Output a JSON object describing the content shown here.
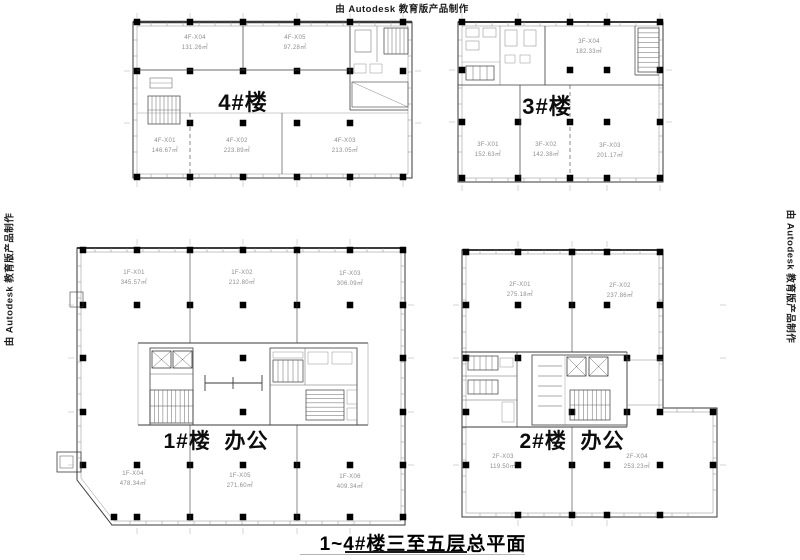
{
  "watermarks": {
    "top": "由 Autodesk 教育版产品制作",
    "left": "由 Autodesk 教育版产品制作",
    "right": "由 Autodesk 教育版产品制作"
  },
  "sheet": {
    "title": "1~4#楼三至五层总平面"
  },
  "colors": {
    "line": "#3a3a3a",
    "light_line": "#888888",
    "faint_line": "#aaaaaa",
    "room_text": "#8d8d8d",
    "label_text": "#0d0d0d"
  },
  "buildings": [
    {
      "id": "building-4",
      "label": "4#楼",
      "rooms": [
        {
          "code": "4F-X04",
          "area": "131.26㎡"
        },
        {
          "code": "4F-X05",
          "area": "97.28㎡"
        },
        {
          "code": "4F-X01",
          "area": "146.67㎡"
        },
        {
          "code": "4F-X02",
          "area": "223.89㎡"
        },
        {
          "code": "4F-X03",
          "area": "213.05㎡"
        }
      ]
    },
    {
      "id": "building-3",
      "label": "3#楼",
      "rooms": [
        {
          "code": "3F-X04",
          "area": "182.33㎡"
        },
        {
          "code": "3F-X01",
          "area": "152.63㎡"
        },
        {
          "code": "3F-X02",
          "area": "142.38㎡"
        },
        {
          "code": "3F-X03",
          "area": "201.17㎡"
        }
      ]
    },
    {
      "id": "building-1",
      "label": "1#楼  办公",
      "rooms": [
        {
          "code": "1F-X01",
          "area": "345.57㎡"
        },
        {
          "code": "1F-X02",
          "area": "212.80㎡"
        },
        {
          "code": "1F-X03",
          "area": "306.09㎡"
        },
        {
          "code": "1F-X04",
          "area": "478.34㎡"
        },
        {
          "code": "1F-X05",
          "area": "271.60㎡"
        },
        {
          "code": "1F-X06",
          "area": "409.34㎡"
        }
      ]
    },
    {
      "id": "building-2",
      "label": "2#楼  办公",
      "rooms": [
        {
          "code": "2F-X01",
          "area": "275.18㎡"
        },
        {
          "code": "2F-X02",
          "area": "237.86㎡"
        },
        {
          "code": "2F-X03",
          "area": "119.50㎡"
        },
        {
          "code": "2F-X04",
          "area": "253.23㎡"
        }
      ]
    }
  ]
}
